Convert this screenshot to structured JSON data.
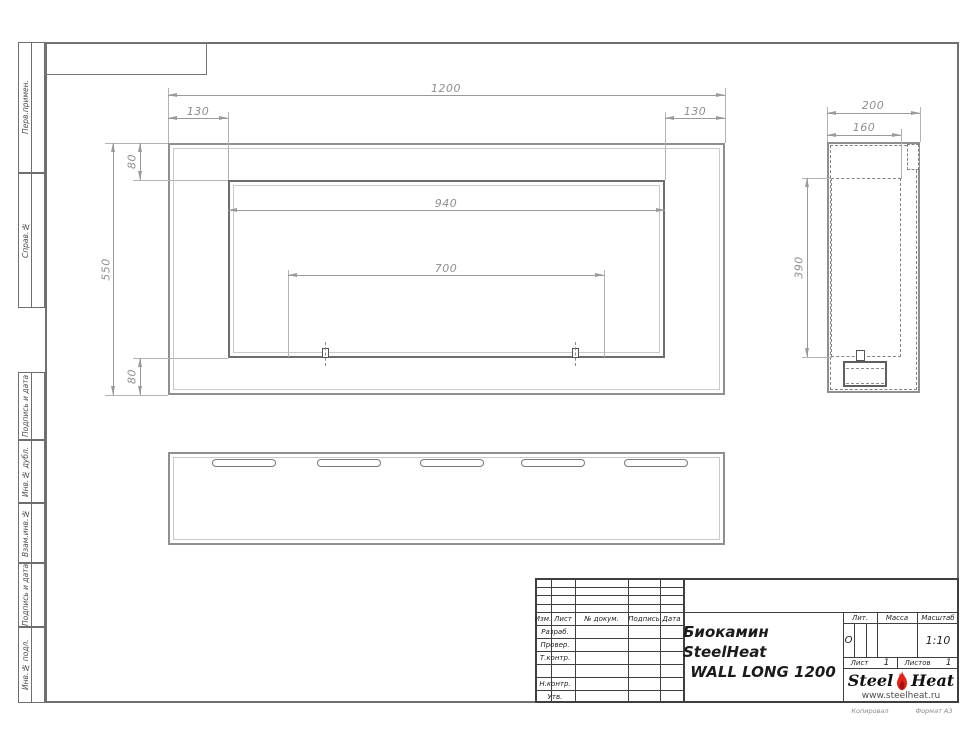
{
  "colors": {
    "drawing_line": "#8f8f8f",
    "dark_line": "#6d6d6d",
    "dimension": "#9a9a9a",
    "title_block_line": "#3f3f3f",
    "logo_red": "#e2231a"
  },
  "left_strip": {
    "sections": [
      {
        "label": "Перв.примен."
      },
      {
        "label": "Справ.№"
      },
      {
        "label": "Подпись и дата"
      },
      {
        "label": "Инв.№ дубл."
      },
      {
        "label": "Взам.инв.№"
      },
      {
        "label": "Подпись и дата"
      },
      {
        "label": "Инв.№ подл."
      }
    ]
  },
  "dims": {
    "front_width": "1200",
    "front_left_inset": "130",
    "front_right_inset": "130",
    "front_top_inset": "80",
    "front_height": "550",
    "front_bottom_inset": "80",
    "front_opening_width": "940",
    "front_burner_span": "700",
    "side_depth": "200",
    "side_inner_depth": "160",
    "side_opening_height": "390"
  },
  "title_block": {
    "revision_header": {
      "izm": "Изм.",
      "list": "Лист",
      "doc": "№ докум.",
      "sign": "Подпись",
      "date": "Дата"
    },
    "roles": {
      "developed": "Разраб.",
      "checked": "Провер.",
      "tcontrol": "Т.контр.",
      "ncontrol": "Н.контр.",
      "approved": "Утв."
    },
    "title_line1": "Биокамин SteelHeat",
    "title_line2": "WALL LONG 1200",
    "lit_label": "Лит.",
    "lit_value": "О",
    "mass_label": "Масса",
    "scale_label": "Масштаб",
    "scale_value": "1:10",
    "sheet_label": "Лист",
    "sheet_value": "1",
    "sheets_label": "Листов",
    "sheets_value": "1",
    "logo_steel": "Steel",
    "logo_heat": "Heat",
    "logo_url": "www.steelheat.ru",
    "copied_label": "Копировал",
    "format_label": "Формат А3"
  }
}
